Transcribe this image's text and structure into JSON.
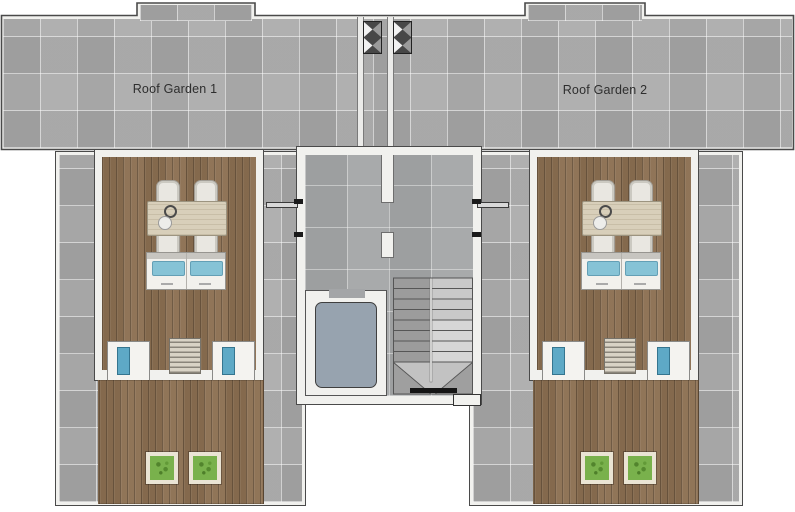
{
  "plan": {
    "labels": {
      "roof_garden_1": "Roof Garden 1",
      "roof_garden_2": "Roof Garden 2"
    },
    "colors": {
      "background": "#ffffff",
      "tile_gray": "#a9a9a9",
      "stair_floor_gray": "#a3a5a7",
      "wall_white": "#f1f1ee",
      "outline_dark": "#4a4a4a",
      "wood_deck": "#8b6f51",
      "table_wood": "#d8cfba",
      "chair_white": "#e9e7e1",
      "cushion_blue": "#86c3d6",
      "hatch_blue": "#5ea9c6",
      "elevator_cab_blue_gray": "#97a3af",
      "planter_green": "#79b14c"
    }
  }
}
